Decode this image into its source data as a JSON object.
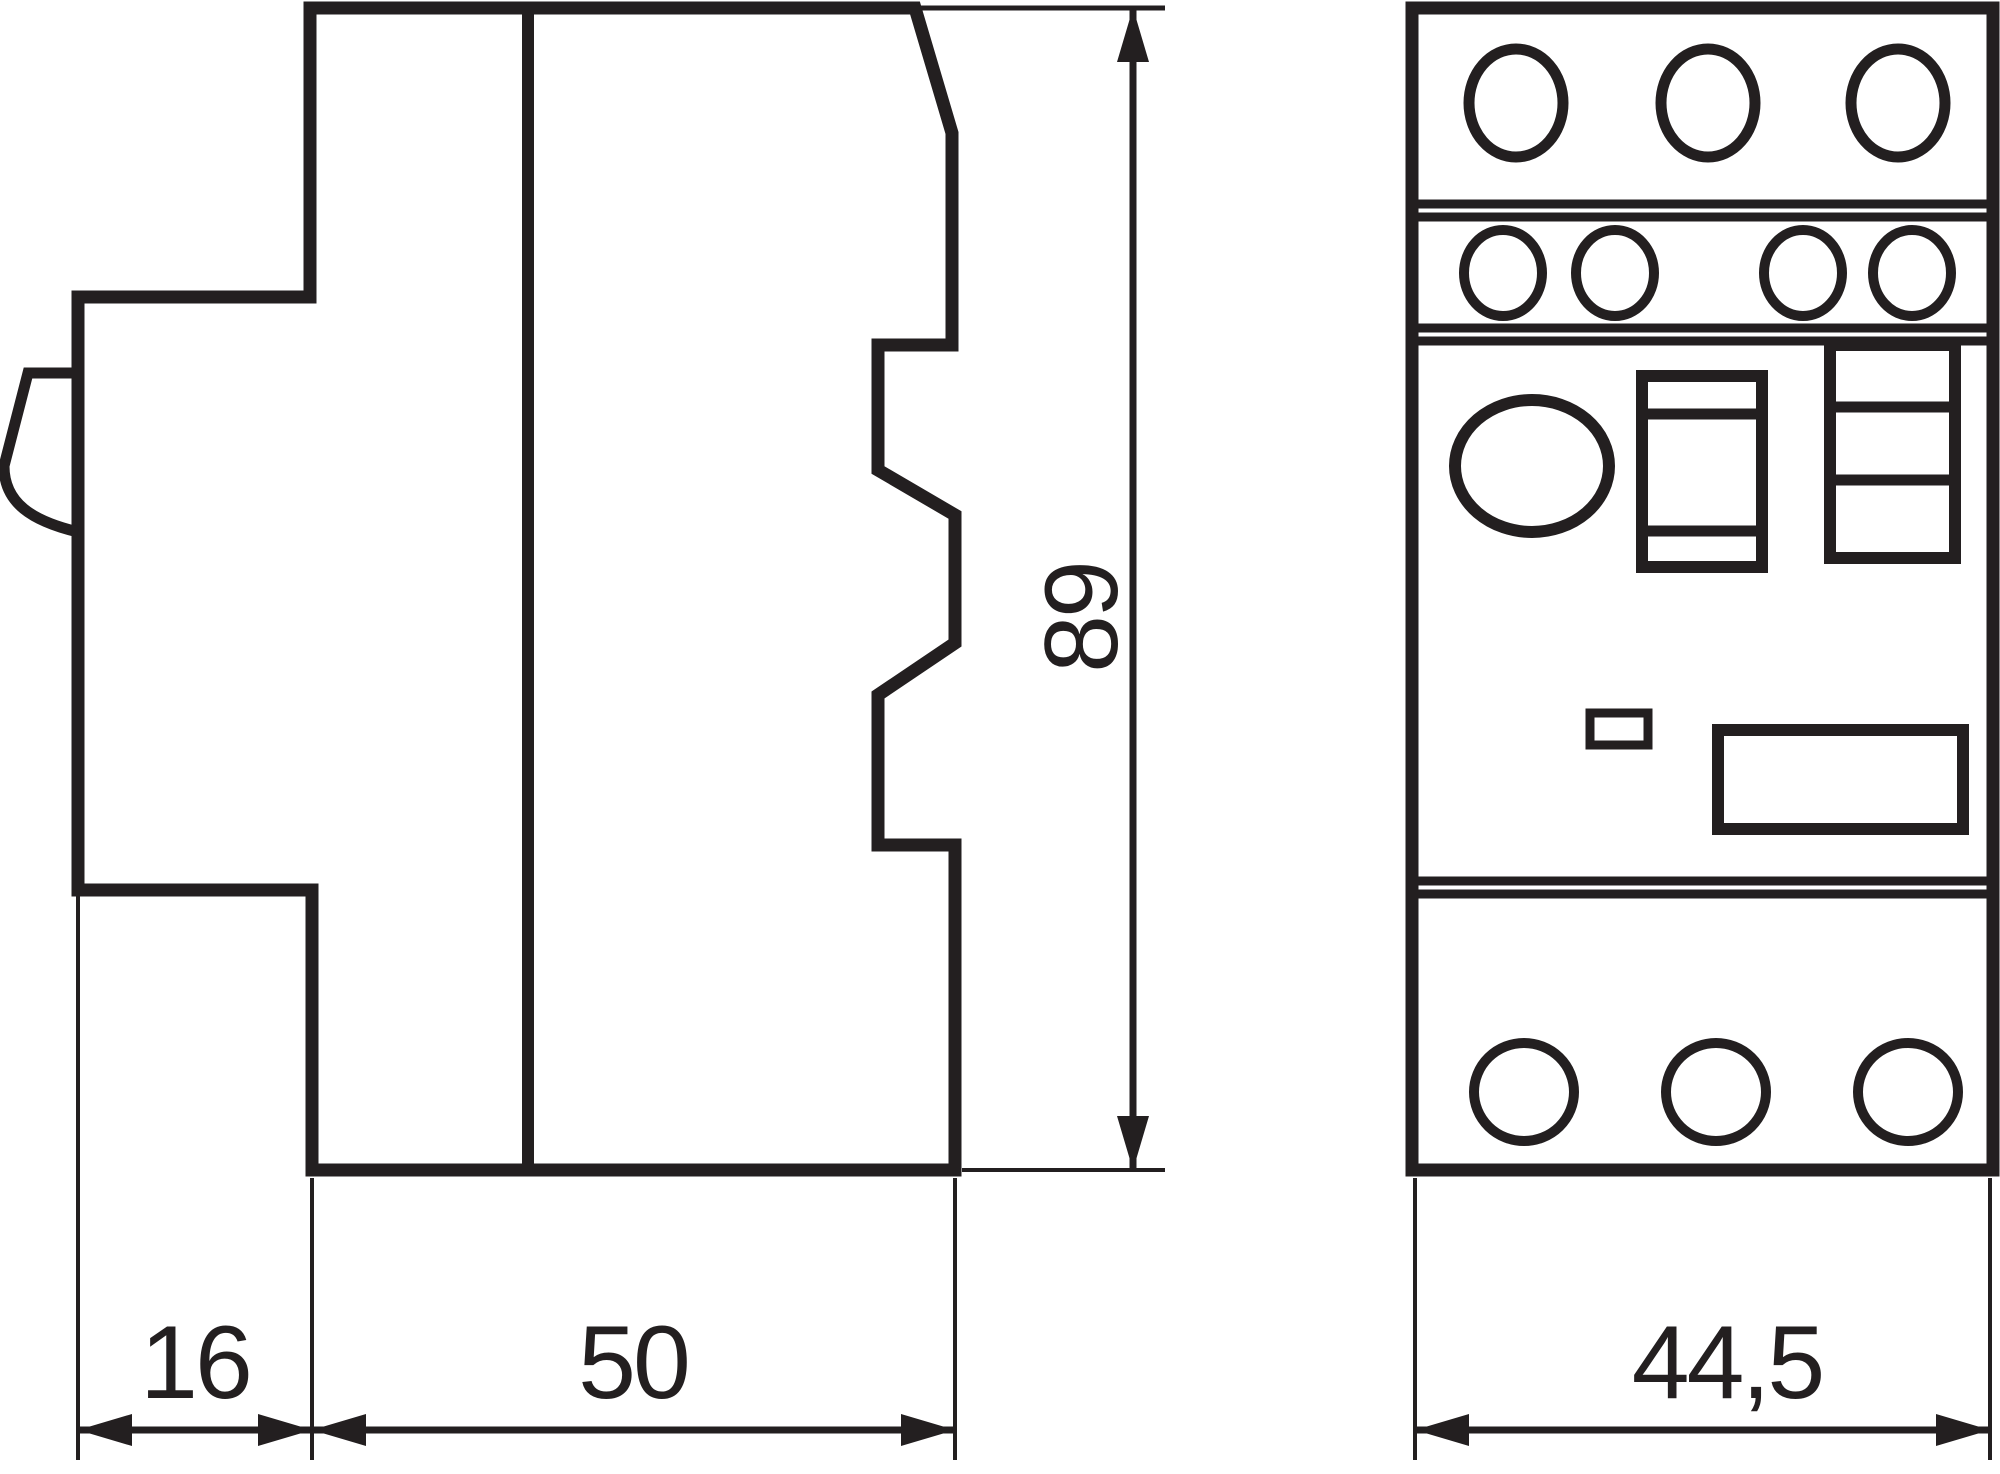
{
  "diagram": {
    "kind": "technical-dimension-drawing",
    "colors": {
      "line": "#231f20",
      "background": "#ffffff"
    }
  },
  "dimensions": {
    "side_height": "89",
    "side_depth_left": "16",
    "side_depth_main": "50",
    "front_width": "44,5"
  }
}
